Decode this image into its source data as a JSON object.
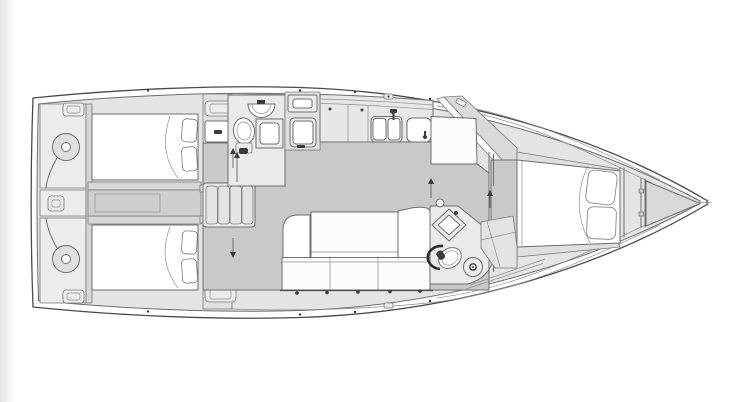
{
  "meta": {
    "title": "Sailing yacht interior layout — top-down floor plan line drawing",
    "type": "boat-floorplan",
    "canvas": {
      "width": 737,
      "height": 402
    },
    "text_content": "none — drawing contains no visible text or labels"
  },
  "colors": {
    "background": "#ffffff",
    "page_edge": "#e6e6e6",
    "hull": "#ffffff",
    "outline": "#6e6e6e",
    "interior": "#e4e4e4",
    "floor": "#c9c9c9",
    "wall": "#d6d6d6",
    "engine": "#cfcfcf",
    "cabinet": "#e0e0e0",
    "counter": "#e7e7e7",
    "room": "#eaeaea",
    "steps": "#e3e3e3",
    "berth": "#ffffff",
    "furniture": "#fcfcfc",
    "fixture": "#ececec",
    "anchor_locker": "#d9d9d9",
    "accent_dark": "#3c3c3c"
  },
  "regions": [
    "hull-outline",
    "stern-lazarettes",
    "steering-quadrant-port",
    "steering-quadrant-starboard",
    "aft-cabin-port",
    "aft-cabin-starboard",
    "engine-compartment",
    "companionway-steps",
    "forward-head",
    "galley",
    "saloon",
    "chart-table",
    "aft-head",
    "forward-cabin",
    "anchor-locker",
    "bow"
  ],
  "fixtures": [
    "double-berth",
    "pillows",
    "toilet",
    "washbasin",
    "shower-tray",
    "double-sink",
    "faucet",
    "stove",
    "salon-table",
    "sofa-cushions",
    "chaise-seat",
    "mast-post",
    "deck-hatch",
    "door-swing-arrow"
  ]
}
